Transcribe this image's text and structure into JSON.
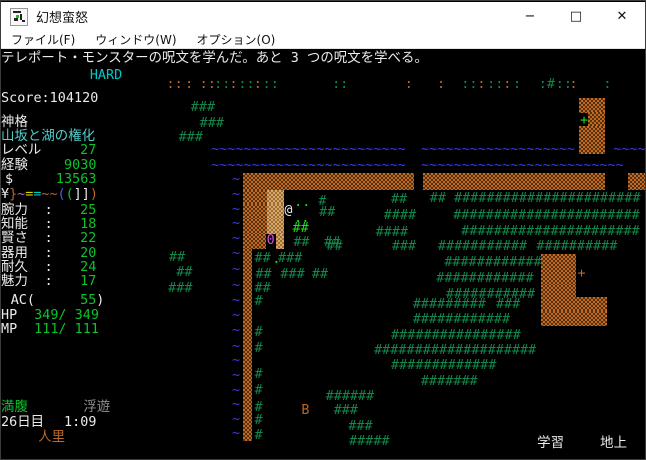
{
  "window": {
    "title": "幻想蛮怒",
    "controls": {
      "minimize": "−",
      "maximize": "□",
      "close": "✕"
    }
  },
  "menu": {
    "items": [
      {
        "label": "ファイル(F)"
      },
      {
        "label": "ウィンドウ(W)"
      },
      {
        "label": "オプション(O)"
      }
    ]
  },
  "palette": {
    "terminal_bg": "#000000",
    "titlebar_bg": "#ffffff",
    "white": "#ececec",
    "value_green": "#0cc32c",
    "tree_green": "#12874b",
    "bright_lime": "#1ae019",
    "orange": "#bd6626",
    "mountain": "#c06a24",
    "tan": "#d8a767",
    "water_blue": "#3c3ce6",
    "cyan": "#00c8c8",
    "light_cyan": "#55cccc",
    "magenta": "#d24fd2",
    "gray": "#8f8f8f",
    "yellow": "#d9d900",
    "blue": "#4c5ce8"
  },
  "terminal": {
    "message": "テレポート・モンスターの呪文を学んだ。あと 3 つの呪文を学べる。",
    "cells": [
      {
        "r": 0.2,
        "c": 0,
        "t": "テレポート・モンスターの呪文を学んだ。あと 3 つの呪文を学べる。",
        "k": "w",
        "n": "message-line"
      },
      {
        "r": 1.35,
        "c": 11,
        "t": "HARD",
        "k": "c",
        "n": "difficulty-label"
      },
      {
        "r": 2.9,
        "c": 0,
        "t": "Score:104120",
        "k": "w",
        "n": "score"
      },
      {
        "r": 4.55,
        "c": 0,
        "t": "神格",
        "k": "w",
        "n": "class-label"
      },
      {
        "r": 5.5,
        "c": 0,
        "t": "山坂と湖の権化",
        "k": "C",
        "n": "character-title"
      },
      {
        "r": 6.45,
        "c": 0,
        "t": "レベル",
        "k": "w",
        "n": "level-label"
      },
      {
        "r": 6.45,
        "c": 9.8,
        "t": "27",
        "k": "g",
        "n": "level-value"
      },
      {
        "r": 7.45,
        "c": 0,
        "t": "経験",
        "k": "w",
        "n": "exp-label"
      },
      {
        "r": 7.45,
        "c": 7.8,
        "t": "9030",
        "k": "g",
        "n": "exp-value"
      },
      {
        "r": 8.45,
        "c": 0.5,
        "t": "$",
        "k": "w",
        "n": "gold-label"
      },
      {
        "r": 8.45,
        "c": 6.8,
        "t": "13563",
        "k": "g",
        "n": "gold-value"
      },
      {
        "r": 9.45,
        "c": 0,
        "t": "¥",
        "k": "w",
        "n": "equip-slot"
      },
      {
        "r": 9.45,
        "c": 1,
        "t": "}",
        "k": "o",
        "n": "equip-slot"
      },
      {
        "r": 9.45,
        "c": 2,
        "t": "~",
        "k": "m",
        "n": "equip-slot"
      },
      {
        "r": 9.45,
        "c": 3,
        "t": "=",
        "k": "y",
        "n": "equip-slot"
      },
      {
        "r": 9.45,
        "c": 4,
        "t": "=",
        "k": "c",
        "n": "equip-slot"
      },
      {
        "r": 9.45,
        "c": 5,
        "t": "~",
        "k": "o",
        "n": "equip-slot"
      },
      {
        "r": 9.45,
        "c": 6,
        "t": "~",
        "k": "o",
        "n": "equip-slot"
      },
      {
        "r": 9.45,
        "c": 7,
        "t": "(",
        "k": "B",
        "n": "equip-slot"
      },
      {
        "r": 9.45,
        "c": 8,
        "t": "(",
        "k": "g",
        "n": "equip-slot"
      },
      {
        "r": 9.45,
        "c": 9,
        "t": "]",
        "k": "w",
        "n": "equip-slot"
      },
      {
        "r": 9.45,
        "c": 10,
        "t": "]",
        "k": "w",
        "n": "equip-slot"
      },
      {
        "r": 9.45,
        "c": 11,
        "t": ")",
        "k": "o",
        "n": "equip-slot"
      },
      {
        "r": 10.55,
        "c": 0,
        "t": "腕力",
        "k": "w",
        "n": "str-label"
      },
      {
        "r": 10.55,
        "c": 5.4,
        "t": ":",
        "k": "w"
      },
      {
        "r": 10.55,
        "c": 9.8,
        "t": "25",
        "k": "g",
        "n": "str-value"
      },
      {
        "r": 11.5,
        "c": 0,
        "t": "知能",
        "k": "w",
        "n": "int-label"
      },
      {
        "r": 11.5,
        "c": 5.4,
        "t": ":",
        "k": "w"
      },
      {
        "r": 11.5,
        "c": 9.8,
        "t": "18",
        "k": "g",
        "n": "int-value"
      },
      {
        "r": 12.45,
        "c": 0,
        "t": "賢さ",
        "k": "w",
        "n": "wis-label"
      },
      {
        "r": 12.45,
        "c": 5.4,
        "t": ":",
        "k": "w"
      },
      {
        "r": 12.45,
        "c": 9.8,
        "t": "22",
        "k": "g",
        "n": "wis-value"
      },
      {
        "r": 13.45,
        "c": 0,
        "t": "器用",
        "k": "w",
        "n": "dex-label"
      },
      {
        "r": 13.45,
        "c": 5.4,
        "t": ":",
        "k": "w"
      },
      {
        "r": 13.45,
        "c": 9.8,
        "t": "20",
        "k": "g",
        "n": "dex-value"
      },
      {
        "r": 14.4,
        "c": 0,
        "t": "耐久",
        "k": "w",
        "n": "con-label"
      },
      {
        "r": 14.4,
        "c": 5.4,
        "t": ":",
        "k": "w"
      },
      {
        "r": 14.4,
        "c": 9.8,
        "t": "24",
        "k": "g",
        "n": "con-value"
      },
      {
        "r": 15.35,
        "c": 0,
        "t": "魅力",
        "k": "w",
        "n": "chr-label"
      },
      {
        "r": 15.35,
        "c": 5.4,
        "t": ":",
        "k": "w"
      },
      {
        "r": 15.35,
        "c": 9.8,
        "t": "17",
        "k": "g",
        "n": "chr-value"
      },
      {
        "r": 16.65,
        "c": 1.2,
        "t": "AC(",
        "k": "w",
        "n": "ac-label"
      },
      {
        "r": 16.65,
        "c": 9.8,
        "t": "55",
        "k": "g",
        "n": "ac-value"
      },
      {
        "r": 16.65,
        "c": 11.8,
        "t": ")",
        "k": "w"
      },
      {
        "r": 17.65,
        "c": 0,
        "t": "HP",
        "k": "w",
        "n": "hp-label"
      },
      {
        "r": 17.65,
        "c": 4.1,
        "t": "349/ 349",
        "k": "g",
        "n": "hp-value"
      },
      {
        "r": 18.65,
        "c": 0,
        "t": "MP",
        "k": "w",
        "n": "mp-label"
      },
      {
        "r": 18.65,
        "c": 4.1,
        "t": "111/ 111",
        "k": "g",
        "n": "mp-value"
      },
      {
        "r": 23.95,
        "c": 0,
        "t": "満腹",
        "k": "g",
        "n": "food-status"
      },
      {
        "r": 23.95,
        "c": 10.2,
        "t": "浮遊",
        "k": "gy",
        "n": "levitation-status"
      },
      {
        "r": 24.95,
        "c": 0,
        "t": "26日目",
        "k": "w",
        "n": "day-counter"
      },
      {
        "r": 24.95,
        "c": 7.8,
        "t": "1:09",
        "k": "w",
        "n": "clock"
      },
      {
        "r": 25.95,
        "c": 4.6,
        "t": "人里",
        "k": "o",
        "n": "location-label"
      },
      {
        "r": 26.35,
        "c": 66.4,
        "t": "学習",
        "k": "w",
        "n": "study-indicator"
      },
      {
        "r": 26.35,
        "c": 74.2,
        "t": "地上",
        "k": "w",
        "n": "depth-indicator"
      },
      {
        "r": 2.0,
        "c": 20.5,
        "t": "::",
        "k": "o"
      },
      {
        "r": 2.0,
        "c": 22.8,
        "t": ":",
        "k": "o"
      },
      {
        "r": 2.0,
        "c": 24.6,
        "t": "::",
        "k": "o"
      },
      {
        "r": 2.0,
        "c": 26.4,
        "t": "::",
        "k": "t"
      },
      {
        "r": 2.0,
        "c": 28.3,
        "t": ":",
        "k": "o"
      },
      {
        "r": 2.0,
        "c": 29.4,
        "t": "::",
        "k": "t"
      },
      {
        "r": 2.0,
        "c": 31.3,
        "t": ":",
        "k": "o"
      },
      {
        "r": 2.0,
        "c": 32.4,
        "t": "::",
        "k": "t"
      },
      {
        "r": 2.0,
        "c": 41,
        "t": "::",
        "k": "t"
      },
      {
        "r": 2.0,
        "c": 50,
        "t": ":",
        "k": "o"
      },
      {
        "r": 2.0,
        "c": 54,
        "t": ":",
        "k": "o"
      },
      {
        "r": 2.0,
        "c": 57,
        "t": "::",
        "k": "t"
      },
      {
        "r": 2.0,
        "c": 59,
        "t": ":",
        "k": "o"
      },
      {
        "r": 2.0,
        "c": 60.2,
        "t": "::",
        "k": "t"
      },
      {
        "r": 2.0,
        "c": 62.2,
        "t": ":",
        "k": "o"
      },
      {
        "r": 2.0,
        "c": 63.4,
        "t": ":",
        "k": "t"
      },
      {
        "r": 2.0,
        "c": 66.6,
        "t": ":",
        "k": "t"
      },
      {
        "r": 2.0,
        "c": 67.6,
        "t": "#",
        "k": "t"
      },
      {
        "r": 2.0,
        "c": 68.7,
        "t": "::",
        "k": "t"
      },
      {
        "r": 2.0,
        "c": 70.4,
        "t": ":",
        "k": "o"
      },
      {
        "r": 2.0,
        "c": 74.6,
        "t": ":",
        "k": "t"
      },
      {
        "r": 3.55,
        "c": 23.5,
        "t": "###",
        "k": "t"
      },
      {
        "r": 4.65,
        "c": 24.6,
        "t": "###",
        "k": "t"
      },
      {
        "r": 5.6,
        "c": 22,
        "t": "###",
        "k": "t"
      },
      {
        "r": 3.3,
        "c": 71.6,
        "w": 3.2,
        "k": "M"
      },
      {
        "r": 4.28,
        "c": 72.7,
        "w": 2.1,
        "k": "M"
      },
      {
        "r": 4.45,
        "c": 71.7,
        "t": "+",
        "k": "G",
        "n": "door"
      },
      {
        "r": 5.26,
        "c": 71.6,
        "w": 3.2,
        "k": "M"
      },
      {
        "r": 6.05,
        "c": 71.6,
        "w": 3.2,
        "k": "M"
      },
      {
        "r": 6.4,
        "c": 26,
        "t": "~~~~~~~~~~~~~~~~~~~~~~~~",
        "k": "b"
      },
      {
        "r": 6.4,
        "c": 52,
        "t": "~~~~~~~~~~~~~~~~~~~",
        "k": "b"
      },
      {
        "r": 6.4,
        "c": 75.8,
        "t": "~~~~",
        "k": "b"
      },
      {
        "r": 7.45,
        "c": 26,
        "t": "~~~~~~~~~~~~~~~~~~~~~~~~",
        "k": "b"
      },
      {
        "r": 7.45,
        "c": 52,
        "t": "~~~~~~~~~~~~~~~~~~~~~~~~~",
        "k": "b"
      },
      {
        "r": 8.4,
        "c": 30,
        "w": 21.2,
        "k": "M",
        "h": 1.15
      },
      {
        "r": 8.4,
        "c": 52.3,
        "w": 22.5,
        "k": "M",
        "h": 1.15
      },
      {
        "r": 8.4,
        "c": 77.6,
        "w": 2.4,
        "k": "M",
        "h": 1.15
      },
      {
        "r": 8.45,
        "c": 28.6,
        "t": "~",
        "k": "b"
      },
      {
        "r": 9.45,
        "c": 28.6,
        "t": "~",
        "k": "b"
      },
      {
        "r": 10.45,
        "c": 28.6,
        "t": "~",
        "k": "b"
      },
      {
        "r": 11.45,
        "c": 28.6,
        "t": "~",
        "k": "b"
      },
      {
        "r": 12.45,
        "c": 28.6,
        "t": "~",
        "k": "b"
      },
      {
        "r": 13.45,
        "c": 28.6,
        "t": "~",
        "k": "b"
      },
      {
        "r": 14.55,
        "c": 28.6,
        "t": "~",
        "k": "b"
      },
      {
        "r": 15.6,
        "c": 28.6,
        "t": "~",
        "k": "b"
      },
      {
        "r": 16.65,
        "c": 28.6,
        "t": "~",
        "k": "b"
      },
      {
        "r": 17.7,
        "c": 28.6,
        "t": "~",
        "k": "b"
      },
      {
        "r": 18.7,
        "c": 28.6,
        "t": "~",
        "k": "b"
      },
      {
        "r": 19.75,
        "c": 28.6,
        "t": "~",
        "k": "b"
      },
      {
        "r": 20.75,
        "c": 28.6,
        "t": "~",
        "k": "b"
      },
      {
        "r": 21.75,
        "c": 28.6,
        "t": "~",
        "k": "b"
      },
      {
        "r": 22.75,
        "c": 28.6,
        "t": "~",
        "k": "b"
      },
      {
        "r": 23.75,
        "c": 28.6,
        "t": "~",
        "k": "b"
      },
      {
        "r": 24.75,
        "c": 28.6,
        "t": "~",
        "k": "b"
      },
      {
        "r": 25.7,
        "c": 28.6,
        "t": "~",
        "k": "b"
      },
      {
        "r": 9.55,
        "c": 30,
        "w": 3,
        "k": "M"
      },
      {
        "r": 9.55,
        "c": 33,
        "w": 2.1,
        "k": "T"
      },
      {
        "r": 10.55,
        "c": 30,
        "w": 3,
        "k": "M"
      },
      {
        "r": 10.55,
        "c": 33,
        "w": 2.1,
        "k": "T"
      },
      {
        "r": 10.55,
        "c": 35.1,
        "t": "@",
        "k": "w",
        "n": "player-at"
      },
      {
        "r": 11.55,
        "c": 30,
        "w": 3,
        "k": "M"
      },
      {
        "r": 11.55,
        "c": 33,
        "w": 2.1,
        "k": "T"
      },
      {
        "r": 12.55,
        "c": 30,
        "w": 2.8,
        "k": "M"
      },
      {
        "r": 12.6,
        "c": 32.9,
        "t": "0",
        "k": "m",
        "n": "monster-0"
      },
      {
        "r": 12.55,
        "c": 34,
        "w": 1.1,
        "k": "T"
      },
      {
        "r": 13.6,
        "c": 30,
        "w": 1.05,
        "k": "M",
        "h": 13
      },
      {
        "r": 10.0,
        "c": 36.3,
        "t": ".",
        "k": "G"
      },
      {
        "r": 10.0,
        "c": 37.3,
        "t": ".",
        "k": "G"
      },
      {
        "r": 11.1,
        "c": 36.3,
        "t": ".",
        "k": "G"
      },
      {
        "r": 11.1,
        "c": 37.2,
        "t": ".",
        "k": "G"
      },
      {
        "r": 11.75,
        "c": 36.1,
        "t": "##",
        "k": "G"
      },
      {
        "r": 12.7,
        "c": 36.2,
        "t": "##",
        "k": "t"
      },
      {
        "r": 12.7,
        "c": 40,
        "t": "##",
        "k": "t"
      },
      {
        "r": 9.95,
        "c": 39.3,
        "t": "#",
        "k": "t"
      },
      {
        "r": 10.7,
        "c": 39.4,
        "t": "##",
        "k": "t"
      },
      {
        "r": 9.8,
        "c": 48.3,
        "t": "##",
        "k": "t"
      },
      {
        "r": 10.9,
        "c": 47.4,
        "t": "####",
        "k": "t"
      },
      {
        "r": 12.0,
        "c": 46.4,
        "t": "####",
        "k": "t"
      },
      {
        "r": 13.0,
        "c": 40.3,
        "t": "##",
        "k": "t"
      },
      {
        "r": 13.0,
        "c": 48.4,
        "t": "###",
        "k": "t"
      },
      {
        "r": 9.75,
        "c": 53.1,
        "t": "##",
        "k": "t"
      },
      {
        "r": 9.75,
        "c": 56.1,
        "t": "#######################",
        "k": "t"
      },
      {
        "r": 10.85,
        "c": 56,
        "t": "#######################",
        "k": "t"
      },
      {
        "r": 11.95,
        "c": 57,
        "t": "######################",
        "k": "t"
      },
      {
        "r": 13.0,
        "c": 54.1,
        "t": "###########",
        "k": "t"
      },
      {
        "r": 13.0,
        "c": 66.3,
        "t": "##########",
        "k": "t"
      },
      {
        "r": 14.05,
        "c": 54.9,
        "t": "############",
        "k": "t"
      },
      {
        "r": 15.15,
        "c": 53.9,
        "t": "############",
        "k": "t"
      },
      {
        "r": 16.25,
        "c": 55.1,
        "t": "###########",
        "k": "t"
      },
      {
        "r": 13.95,
        "c": 66.9,
        "w": 4.3,
        "k": "M"
      },
      {
        "r": 15.0,
        "c": 66.9,
        "w": 4.3,
        "k": "M"
      },
      {
        "r": 14.8,
        "c": 71.4,
        "t": "+",
        "k": "o",
        "n": "door"
      },
      {
        "r": 16.05,
        "c": 66.9,
        "w": 4.3,
        "k": "M"
      },
      {
        "r": 16.85,
        "c": 66.9,
        "w": 8.1,
        "k": "M"
      },
      {
        "r": 17.8,
        "c": 66.9,
        "w": 8.1,
        "k": "M"
      },
      {
        "r": 16.95,
        "c": 51,
        "t": "#########",
        "k": "t"
      },
      {
        "r": 16.95,
        "c": 61.3,
        "t": "###",
        "k": "t"
      },
      {
        "r": 17.95,
        "c": 51,
        "t": "############",
        "k": "t"
      },
      {
        "r": 19.0,
        "c": 48.3,
        "t": "################",
        "k": "t"
      },
      {
        "r": 20.05,
        "c": 46.2,
        "t": "####################",
        "k": "t"
      },
      {
        "r": 21.1,
        "c": 48.3,
        "t": "#############",
        "k": "t"
      },
      {
        "r": 22.15,
        "c": 52,
        "t": "#######",
        "k": "t"
      },
      {
        "r": 23.15,
        "c": 40.2,
        "t": "######",
        "k": "t"
      },
      {
        "r": 24.15,
        "c": 37.2,
        "t": "B",
        "k": "o",
        "n": "monster-b"
      },
      {
        "r": 24.15,
        "c": 41.2,
        "t": "###",
        "k": "t"
      },
      {
        "r": 25.2,
        "c": 43,
        "t": "###",
        "k": "t"
      },
      {
        "r": 26.2,
        "c": 43.1,
        "t": "#####",
        "k": "t"
      },
      {
        "r": 13.75,
        "c": 20.8,
        "t": "##",
        "k": "t"
      },
      {
        "r": 14.75,
        "c": 21.7,
        "t": "##",
        "k": "t"
      },
      {
        "r": 15.85,
        "c": 20.7,
        "t": "###",
        "k": "t"
      },
      {
        "r": 13.8,
        "c": 31.4,
        "t": "##",
        "k": "t"
      },
      {
        "r": 13.85,
        "c": 33.6,
        "t": ".",
        "k": "G"
      },
      {
        "r": 13.8,
        "c": 34.3,
        "t": "###",
        "k": "t"
      },
      {
        "r": 14.85,
        "c": 34.6,
        "t": "###",
        "k": "t"
      },
      {
        "r": 14.85,
        "c": 38.5,
        "t": "##",
        "k": "t"
      },
      {
        "r": 14.9,
        "c": 31.5,
        "t": "##",
        "k": "t"
      },
      {
        "r": 15.85,
        "c": 31.4,
        "t": "##",
        "k": "t"
      },
      {
        "r": 16.7,
        "c": 31.4,
        "t": "#",
        "k": "t"
      },
      {
        "r": 18.85,
        "c": 31.4,
        "t": "#",
        "k": "t"
      },
      {
        "r": 19.9,
        "c": 31.4,
        "t": "#",
        "k": "t"
      },
      {
        "r": 21.7,
        "c": 31.4,
        "t": "#",
        "k": "t"
      },
      {
        "r": 22.8,
        "c": 31.4,
        "t": "#",
        "k": "t"
      },
      {
        "r": 23.9,
        "c": 31.4,
        "t": "#",
        "k": "t"
      },
      {
        "r": 24.8,
        "c": 31.4,
        "t": "#",
        "k": "t"
      },
      {
        "r": 25.8,
        "c": 31.4,
        "t": "#",
        "k": "t"
      }
    ]
  }
}
